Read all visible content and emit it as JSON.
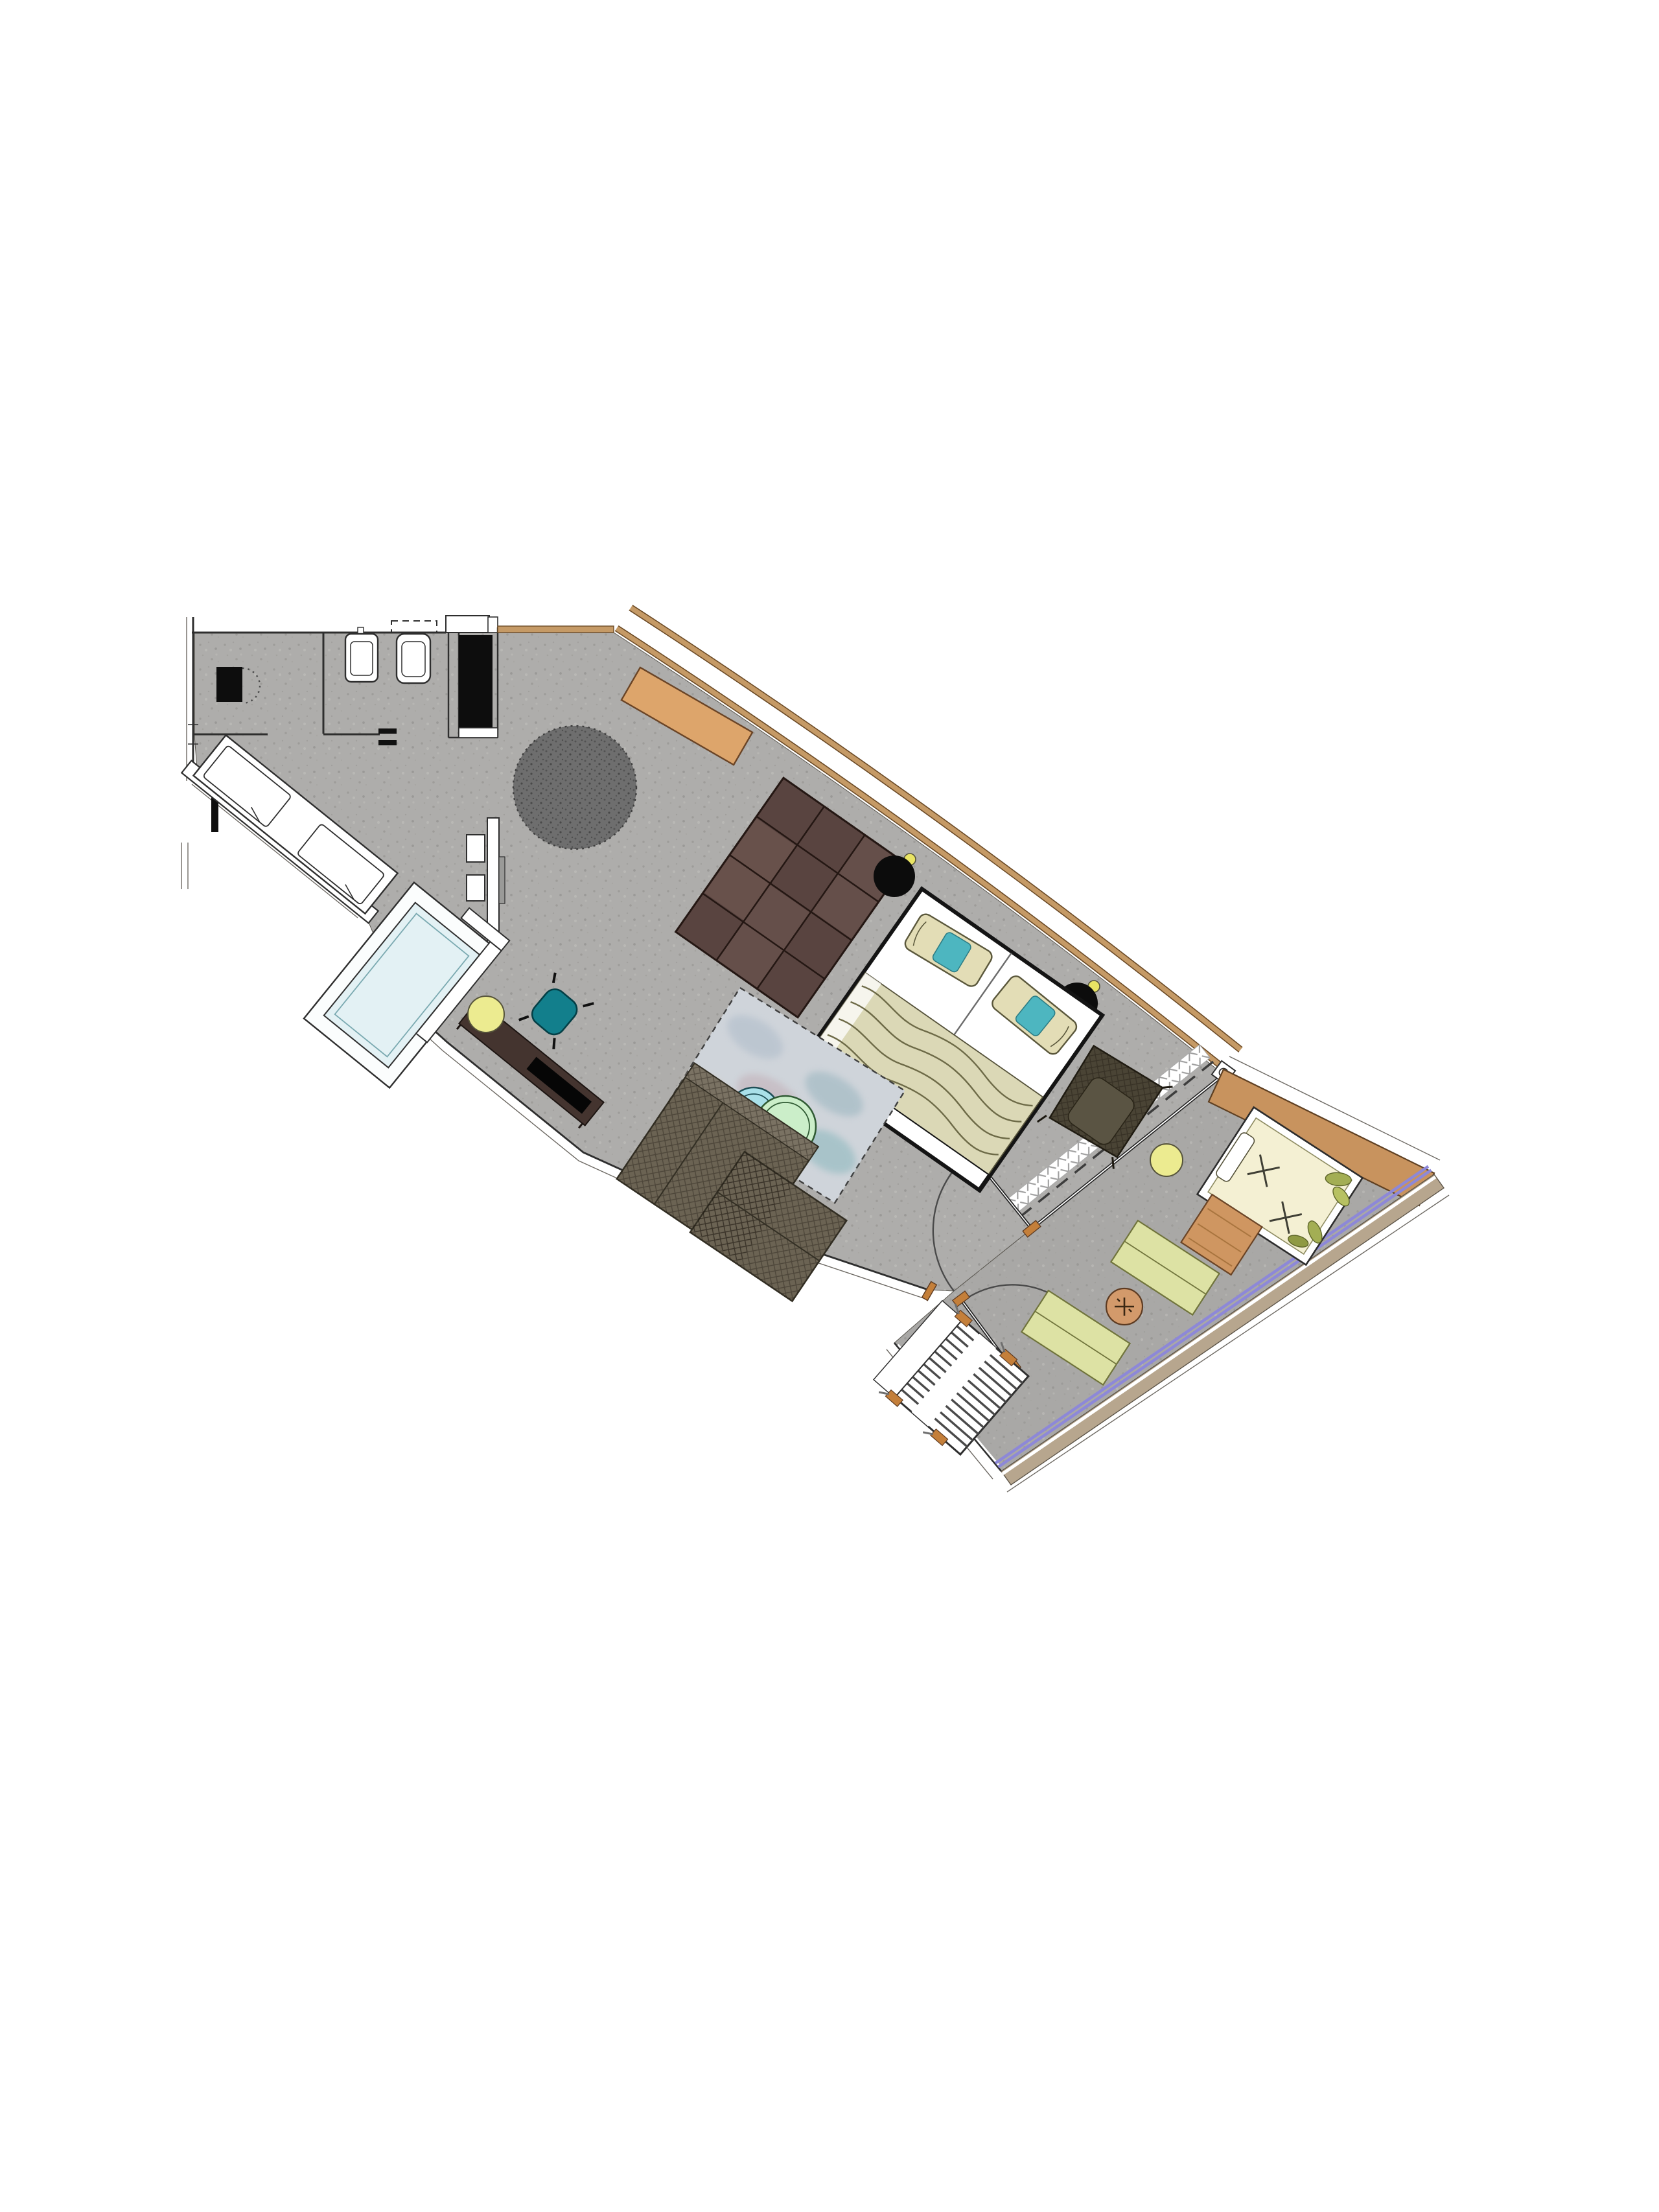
{
  "title": "apartment-suite-floor-plan",
  "scene": "top-down architectural floor plan of a studio hotel suite with entry bathroom block, open living-sleeping space behind a sloped timber-framed glass facade, bathtub bay, and a tapering furnished balcony terrace",
  "rooms": [
    {
      "name": "wc-room"
    },
    {
      "name": "vanity-room"
    },
    {
      "name": "entry-hall"
    },
    {
      "name": "living-bedroom"
    },
    {
      "name": "bathtub-bay"
    },
    {
      "name": "balcony-terrace"
    }
  ],
  "furniture": [
    "wc-fixture",
    "vanity-sinks",
    "overhead-shelf",
    "wardrobe",
    "wardrobe-shelf",
    "window-bench-daybed",
    "bench-cushions",
    "bathtub",
    "privacy-screen",
    "dressing-screen",
    "stools",
    "round-rug",
    "console-desk",
    "modular-sofa",
    "double-bed",
    "bed-pillows",
    "bed-blanket",
    "bedside-table-left",
    "bedside-table-right",
    "wall-lamp-left",
    "wall-lamp-right",
    "armchair",
    "watercolor-rug",
    "nesting-table-cyan",
    "nesting-table-green",
    "chaise-sectional",
    "media-sideboard",
    "tv",
    "yellow-pouf",
    "teal-chair",
    "curtain",
    "glass-partition",
    "partition-door",
    "balcony-door",
    "outdoor-daybed",
    "daybed-plants",
    "outdoor-side-table-yellow",
    "outdoor-wood-table",
    "floor-cushion-pair-a",
    "floor-cushion-pair-b",
    "grill-side-table",
    "slatted-lounger",
    "wood-privacy-screen",
    "glass-balustrade",
    "deck-edge"
  ],
  "colors": {
    "background": "#ffffff",
    "floor": "#aeadab",
    "floor_balcony": "#a9a8a6",
    "wall_line": "#2e2e2e",
    "wood_frame": "#c59a66",
    "screen_wood": "#c8935e",
    "desk_wood": "#dda56b",
    "round_rug": "#6e6e6e",
    "sofa_brown": "#594440",
    "bed_white": "#ffffff",
    "blanket": "#dbd8b6",
    "pillow": "#e3ddb6",
    "pillow_accent": "#4db6c0",
    "side_table_black": "#0c0c0c",
    "lamp_yellow": "#e9e464",
    "armchair_dark": "#4a4435",
    "watercolor_rug": "#cfd4da",
    "table_cyan": "#a9e0e9",
    "table_green": "#cbeec9",
    "chaise_gray": "#6b6353",
    "sideboard_brown": "#44342f",
    "tv_black": "#060606",
    "pouf_yellow": "#eceb90",
    "chair_teal": "#127f8c",
    "tub_blue": "#e3f1f4",
    "outdoor_daybed_cream": "#f4f0d3",
    "leaf_olive": "#a3ae54",
    "cushion_green": "#dde2a4",
    "wood_table": "#cf9661",
    "grill_orange": "#d39a6b",
    "balustrade_purple": "#8d88d8",
    "deck_band": "#b7a68e",
    "curtain_gray": "#9f9f9f"
  }
}
